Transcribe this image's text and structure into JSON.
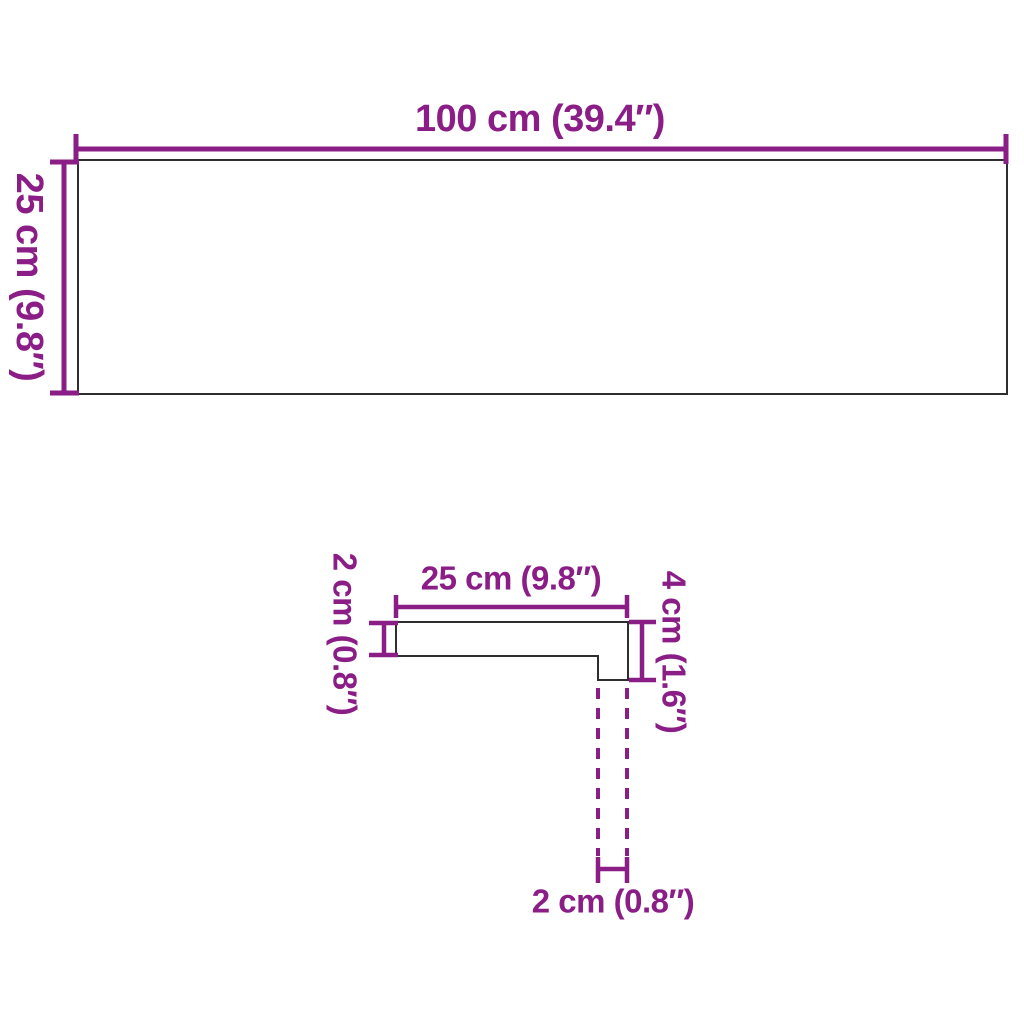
{
  "colors": {
    "dimension": "#8A1E86",
    "outline": "#2E2E2E",
    "background": "#FFFFFF"
  },
  "board_diagram": {
    "width_label": "100 cm (39.4″)",
    "depth_label": "25 cm (9.8″)"
  },
  "profile_diagram": {
    "tread_width_label": "25 cm (9.8″)",
    "thickness_label": "2 cm (0.8″)",
    "total_height_label": "4 cm (1.6″)",
    "nosing_width_label": "2 cm (0.8″)"
  }
}
